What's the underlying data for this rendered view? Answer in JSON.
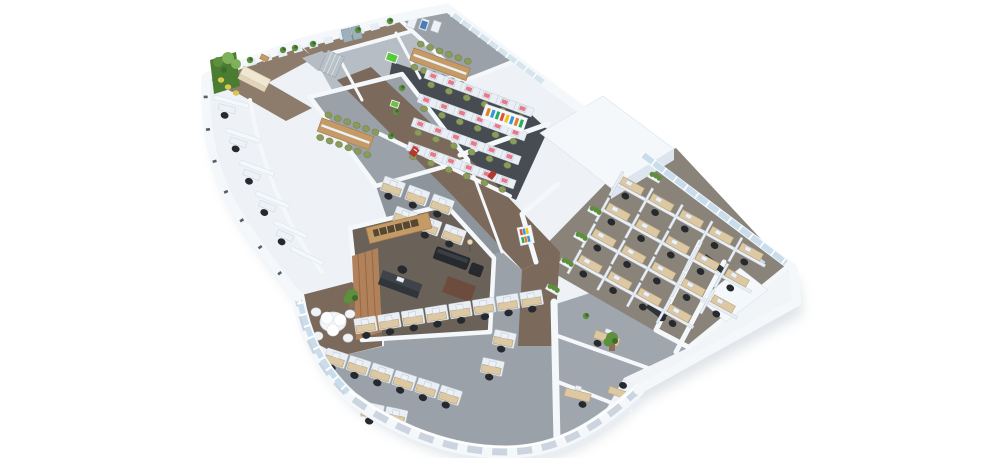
{
  "meta": {
    "description": "3D isometric rendering of an office floor plan with open-plan workstations, meeting rooms, private offices, a reception with green feature wall and a curved glazed colonnade facade",
    "view": "isometric",
    "background": "#ffffff"
  },
  "palette": {
    "background": "#ffffff",
    "shadow": "#b8c1cb",
    "slab": "#eef2f6",
    "wallTop": "#f4f8fb",
    "wallSide": "#dde6ee",
    "glass": "#c9dded",
    "floorCorridor": "#7b6a5c",
    "floorCorridorLight": "#8d7b6b",
    "floorGray": "#9aa1a8",
    "floorGrayDark": "#8e949b",
    "floorRooms": "#b6bdc4",
    "floorDark": "#474c53",
    "floorExec": "#6a6158",
    "floorFarm": "#89837a",
    "floorSE": "#a0a6ad",
    "deskBeige": "#dcc9a4",
    "deskEdge": "#b9a27b",
    "deskDark": "#3f444b",
    "wood": "#c49a66",
    "woodDark": "#a97e4e",
    "woodWall": "#b0815a",
    "furnDark": "#2e3338",
    "chairBlack": "#26292e",
    "chairGreen": "#8a9b5c",
    "chairYellow": "#d8c84f",
    "monitor": "#eef2f6",
    "monitorPink": "#e8788a",
    "plant": "#5d8f3d",
    "plantDark": "#3f6b2a",
    "accentRed": "#b03a30",
    "signGreen": "#57c93c",
    "partition": "#eaeff5",
    "partitionEdge": "#c3cfda",
    "book0": "#e67e22",
    "book1": "#3498db",
    "book2": "#27ae60",
    "book3": "#e74c3c",
    "book4": "#f1c40f"
  },
  "scene": {
    "type": "isometric-office-floorplan",
    "zones": [
      {
        "id": "reception",
        "features": [
          "green-feature-wall",
          "curved-counter",
          "yellow-stools"
        ]
      },
      {
        "id": "entrance-lobby",
        "features": [
          "glass-doors",
          "locker-cabinet",
          "door-mat"
        ]
      },
      {
        "id": "meeting-room-north",
        "seats": 12,
        "features": [
          "long-wood-table",
          "wall-frames"
        ]
      },
      {
        "id": "call-center",
        "rows": 4,
        "seats_per_row": 6,
        "monitor_color": "pink",
        "chair_color": "green"
      },
      {
        "id": "conference-room",
        "seats": 12,
        "features": [
          "long-wood-table"
        ]
      },
      {
        "id": "open-plan-center",
        "workstations": 6
      },
      {
        "id": "executive-office",
        "features": [
          "wood-panel-wall",
          "dark-desk",
          "sofa",
          "rug",
          "floor-lamp"
        ]
      },
      {
        "id": "private-offices-west",
        "count": 5
      },
      {
        "id": "lounge",
        "features": [
          "petal-table",
          "white-chairs",
          "tall-plant"
        ]
      },
      {
        "id": "open-plan-south",
        "rows": 3,
        "workstations": 16
      },
      {
        "id": "cubicle-farm-east",
        "rows": 4,
        "workstations": 19,
        "features": [
          "planters",
          "glazed-facade"
        ]
      },
      {
        "id": "offices-southeast",
        "desks": 3
      },
      {
        "id": "utility-block-east",
        "features": [
          "dark-cabinets",
          "window"
        ]
      },
      {
        "id": "colonnade-south",
        "openings": 12
      },
      {
        "id": "corridor",
        "floor": "brown-carpet"
      }
    ]
  }
}
